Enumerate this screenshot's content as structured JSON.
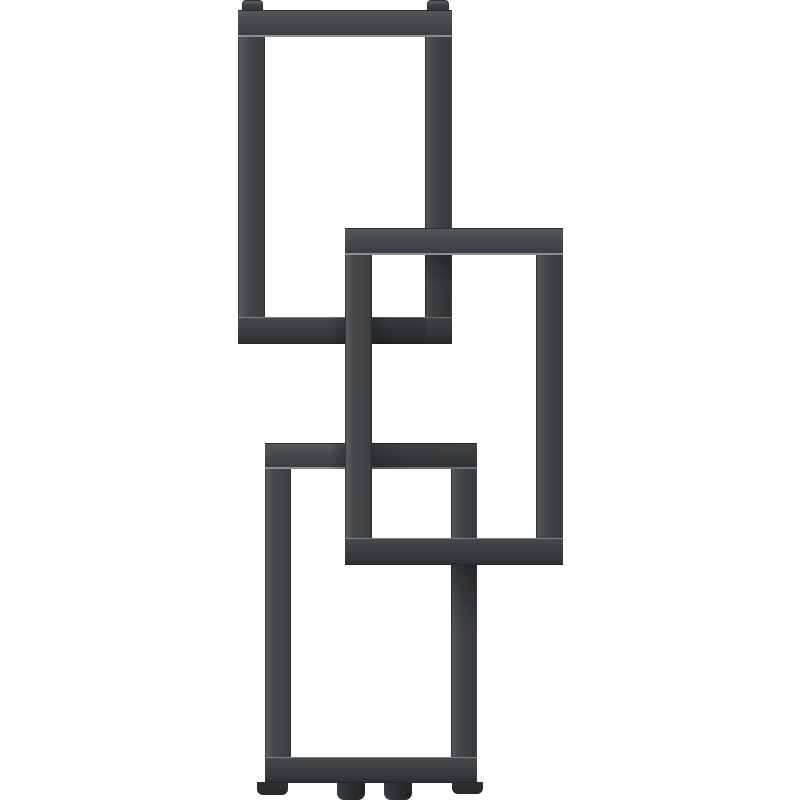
{
  "meta": {
    "description": "Product render of an anthracite designer radiator composed of three interlocking rectangular loops on a white background",
    "object": "designer-radiator",
    "visible_text": []
  },
  "palette": {
    "background": "#ffffff",
    "frame_face": "#47494b",
    "frame_light": "#55585a",
    "frame_dark": "#2c2f31",
    "inner_edge_highlight": "#8b8f91"
  },
  "scene": {
    "canvas": {
      "width": 800,
      "height": 800
    },
    "rectangles": [
      {
        "id": "top-loop-frame",
        "x": 238,
        "y": 10,
        "width": 214,
        "height": 334,
        "thickness": 27,
        "layer": "back"
      },
      {
        "id": "bottom-loop-frame",
        "x": 265,
        "y": 443,
        "width": 212,
        "height": 340,
        "thickness": 26,
        "layer": "back"
      },
      {
        "id": "middle-loop-frame",
        "x": 345,
        "y": 228,
        "width": 218,
        "height": 337,
        "thickness": 27,
        "layer": "front"
      }
    ],
    "caps": [
      {
        "id": "vent-cap-left",
        "x": 242,
        "y": 0,
        "width": 21,
        "height": 11
      },
      {
        "id": "vent-cap-right",
        "x": 427,
        "y": 0,
        "width": 22,
        "height": 11
      }
    ],
    "shadows": [
      {
        "id": "shadow-top-loop-right-bar",
        "x": 425,
        "y": 255,
        "width": 27,
        "height": 89,
        "dir": "down-strong"
      },
      {
        "id": "shadow-top-loop-bottom-bar-right",
        "x": 372,
        "y": 317,
        "width": 53,
        "height": 27,
        "dir": "right"
      },
      {
        "id": "shadow-top-loop-bottom-bar-left",
        "x": 329,
        "y": 317,
        "width": 16,
        "height": 27,
        "dir": "left"
      },
      {
        "id": "shadow-bottom-loop-top-bar-right",
        "x": 372,
        "y": 443,
        "width": 105,
        "height": 26,
        "dir": "right"
      },
      {
        "id": "shadow-bottom-loop-top-bar-left",
        "x": 329,
        "y": 443,
        "width": 16,
        "height": 26,
        "dir": "left"
      },
      {
        "id": "shadow-bottom-loop-right-bar",
        "x": 451,
        "y": 565,
        "width": 26,
        "height": 70,
        "dir": "down"
      }
    ],
    "feet": [
      {
        "id": "foot-left",
        "x": 257,
        "y": 782,
        "width": 31,
        "height": 13,
        "type": "foot"
      },
      {
        "id": "pipe-connection-left",
        "x": 337,
        "y": 782,
        "width": 28,
        "height": 18,
        "type": "pipe"
      },
      {
        "id": "pipe-connection-right",
        "x": 384,
        "y": 782,
        "width": 28,
        "height": 18,
        "type": "pipe"
      },
      {
        "id": "foot-right",
        "x": 452,
        "y": 782,
        "width": 31,
        "height": 12,
        "type": "foot"
      }
    ]
  }
}
